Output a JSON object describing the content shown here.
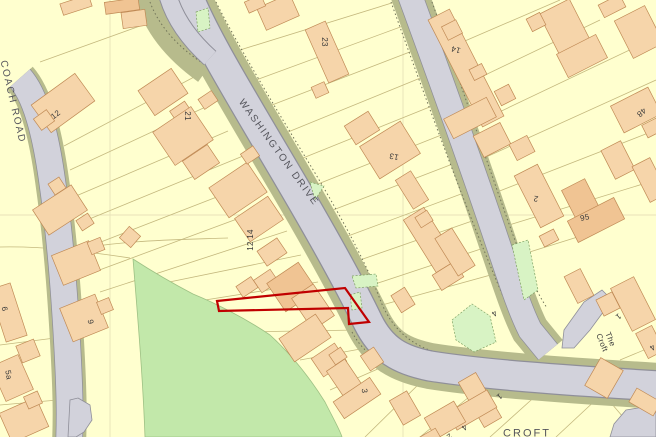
{
  "map": {
    "kind": "os-location-plan",
    "palette": {
      "background": "#FFFFCF",
      "parcel_line": "#C4B87E",
      "building_fill": "#F6D5AA",
      "building_dark": "#F0C493",
      "building_edge": "#C08A55",
      "road_fill": "#D2D2DB",
      "road_edge": "#8F8F99",
      "verge": "#B7BB8C",
      "green_field": "#C2E8AA",
      "green_patch": "#D8F3C4",
      "highlight": "#C00000",
      "text": "#3A3A3A"
    },
    "streets": [
      {
        "id": "coach-road",
        "name": "COACH ROAD"
      },
      {
        "id": "washington-drive",
        "name": "WASHINGTON DRIVE"
      },
      {
        "id": "croft",
        "name": "CROFT"
      },
      {
        "id": "the-croft",
        "name": "The Croft"
      }
    ],
    "house_numbers": [
      {
        "t": "12"
      },
      {
        "t": "21"
      },
      {
        "t": "23"
      },
      {
        "t": "14"
      },
      {
        "t": "13"
      },
      {
        "t": "2"
      },
      {
        "t": "95"
      },
      {
        "t": "48"
      },
      {
        "t": "6"
      },
      {
        "t": "9"
      },
      {
        "t": "5a"
      },
      {
        "t": "12 14"
      },
      {
        "t": "3"
      },
      {
        "t": "1"
      },
      {
        "t": "4"
      },
      {
        "t": "2"
      },
      {
        "t": "4"
      },
      {
        "t": "1"
      },
      {
        "t": "4"
      }
    ],
    "highlight_plot": {
      "color": "#C00000",
      "points": "217,301 345,288 369,322 349,324 348,308 219,311"
    }
  }
}
